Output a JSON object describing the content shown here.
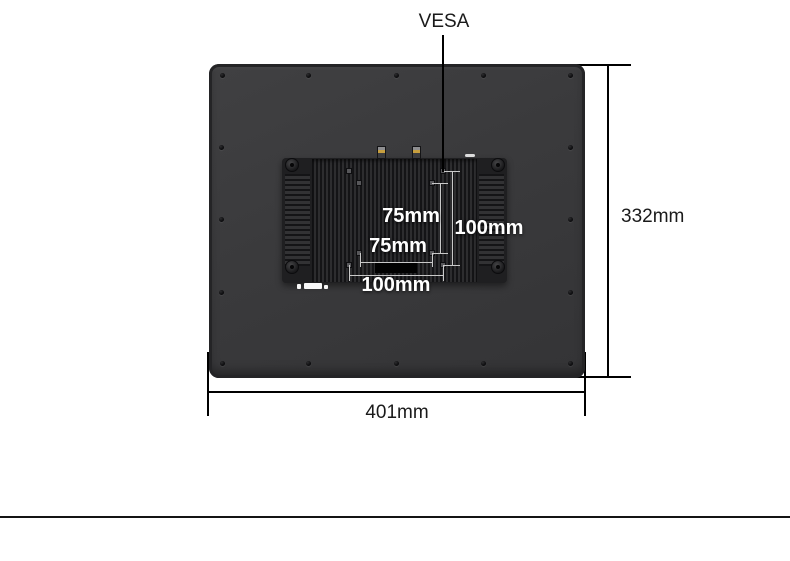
{
  "vesa_mount": {
    "title": "VESA",
    "dim_75_vertical": "75mm",
    "dim_100_vertical": "100mm",
    "dim_75_horizontal": "75mm",
    "dim_100_horizontal": "100mm"
  },
  "overall": {
    "height": "332mm",
    "width": "401mm"
  },
  "colors": {
    "background": "#ffffff",
    "panel_body": "#3a3a3c",
    "heatsink": "#1f1f21",
    "dimension_line": "#000000",
    "dimension_text": "#1a1a1a",
    "vesa_label_text": "#ffffff"
  }
}
